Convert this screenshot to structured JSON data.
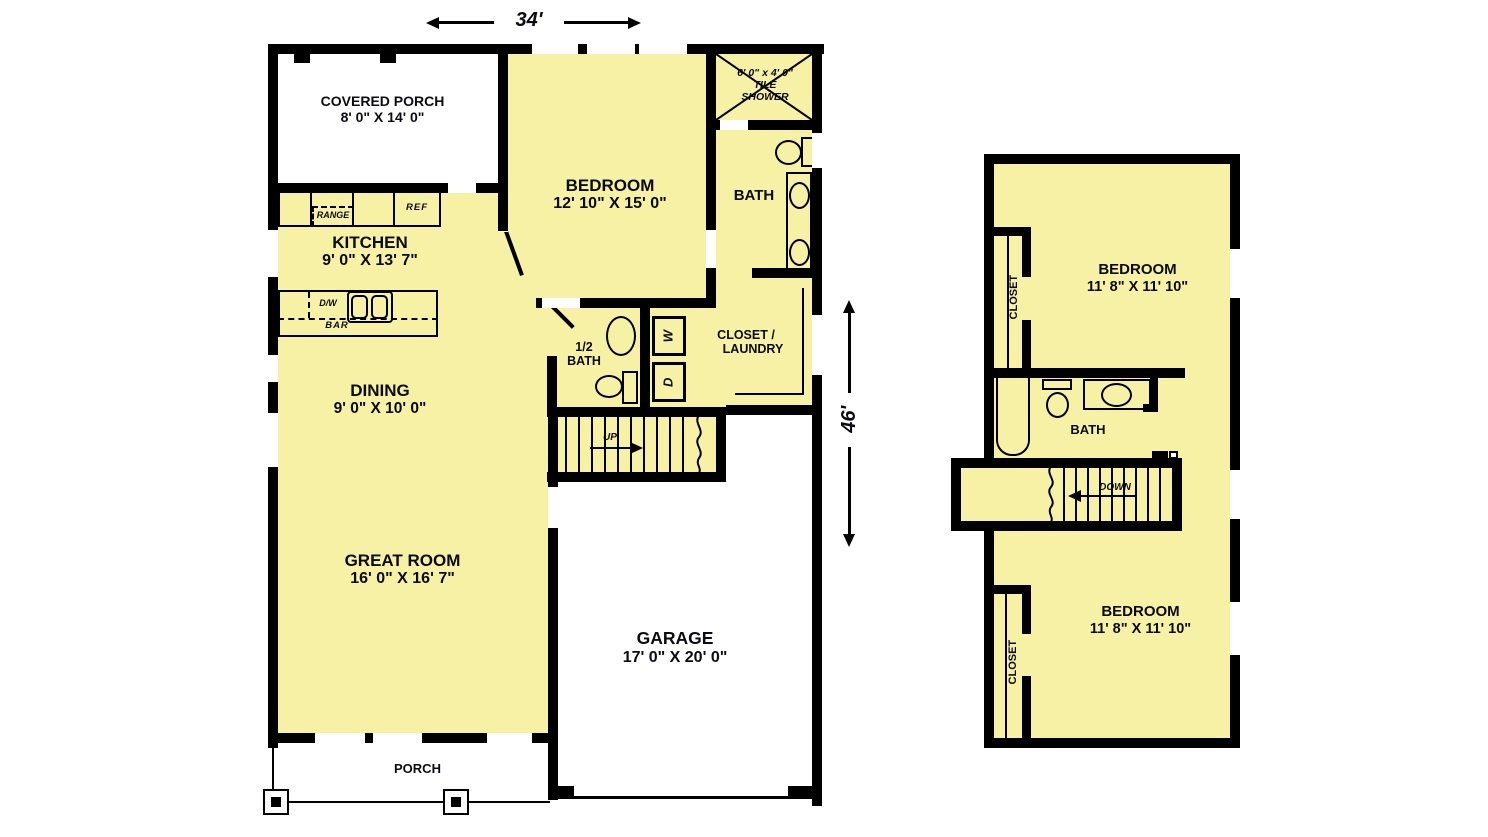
{
  "dims": {
    "width_label": "34'",
    "height_label": "46'"
  },
  "f1": {
    "covered_porch": {
      "name": "COVERED PORCH",
      "size": "8' 0\" X 14' 0\""
    },
    "bedroom": {
      "name": "BEDROOM",
      "size": "12' 10\" X 15' 0\""
    },
    "shower": {
      "size": "6' 0\" x 4' 0\"",
      "l2": "TILE",
      "l3": "SHOWER"
    },
    "bath": {
      "name": "BATH"
    },
    "kitchen": {
      "name": "KITCHEN",
      "size": "9' 0\" X 13' 7\""
    },
    "range": "RANGE",
    "ref": "REF",
    "dw": "D/W",
    "bar": "BAR",
    "dining": {
      "name": "DINING",
      "size": "9' 0\" X 10' 0\""
    },
    "half_bath": {
      "l1": "1/2",
      "l2": "BATH"
    },
    "washer": "W",
    "dryer": "D",
    "closet_laundry": {
      "l1": "CLOSET /",
      "l2": "LAUNDRY"
    },
    "up": "UP",
    "great_room": {
      "name": "GREAT ROOM",
      "size": "16' 0\" X 16' 7\""
    },
    "garage": {
      "name": "GARAGE",
      "size": "17' 0\" X 20' 0\""
    },
    "porch": {
      "name": "PORCH"
    }
  },
  "f2": {
    "bedroom_top": {
      "name": "BEDROOM",
      "size": "11' 8\" X 11' 10\""
    },
    "closet_top": "CLOSET",
    "bath": {
      "name": "BATH"
    },
    "down": "DOWN",
    "bedroom_bottom": {
      "name": "BEDROOM",
      "size": "11' 8\" X 11' 10\""
    },
    "closet_bottom": "CLOSET"
  },
  "colors": {
    "room_fill": "#F7F1A6",
    "wall": "#000000",
    "text": "#0b0b14"
  }
}
